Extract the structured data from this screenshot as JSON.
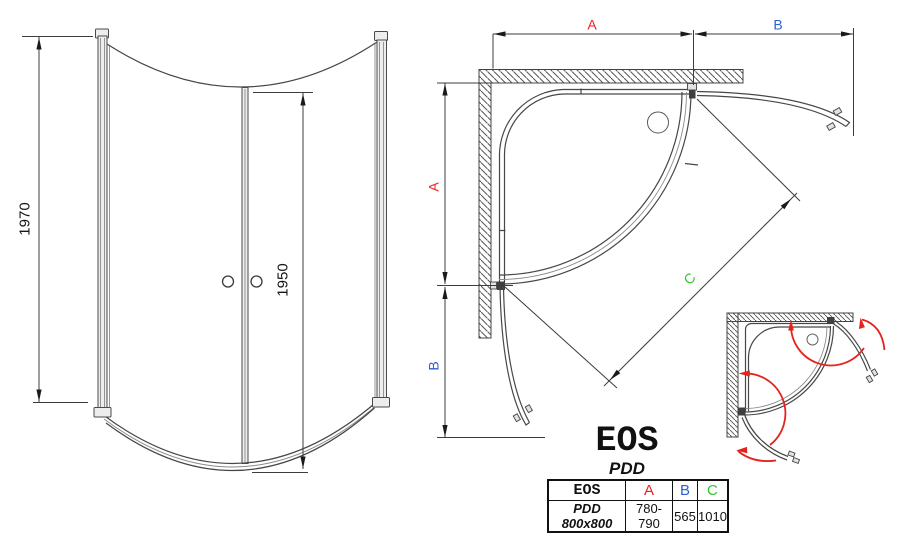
{
  "front_view": {
    "total_height": "1970",
    "door_height": "1950"
  },
  "plan_view": {
    "width_label": "A",
    "ext_label": "B",
    "diag_label": "C"
  },
  "logo": {
    "brand": "EOS",
    "series": "PDD"
  },
  "spec_table": {
    "headers": {
      "model": "EOS",
      "col_a": "A",
      "col_b": "B",
      "col_c": "C"
    },
    "row": {
      "model": "PDD 800x800",
      "a": "780-790",
      "b": "565",
      "c": "1010"
    }
  },
  "colors": {
    "dim_a": "#e8231d",
    "dim_b": "#2d5fd3",
    "dim_c": "#2ec42e",
    "swing_arrow": "#e6221c",
    "line_dark": "#3f3f3f"
  }
}
